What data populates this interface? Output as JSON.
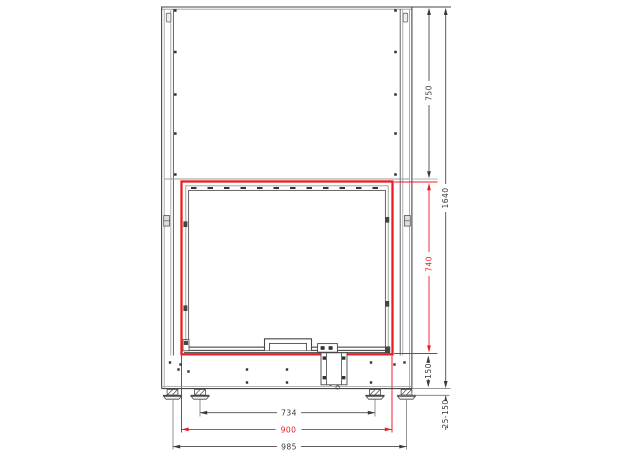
{
  "drawing": {
    "description": "Front elevation technical drawing of a fireplace insert with leveling feet and highlighted firebox opening",
    "colors": {
      "accent_red": "#ed1c24",
      "line_dark": "#474747",
      "line_light": "#9b9b9b"
    },
    "dimensions": {
      "top_section_height": "750",
      "overall_height": "1640",
      "opening_height": "740",
      "plinth_height": "150",
      "leveling_feet_range": "25-150",
      "feet_spacing": "734",
      "opening_width": "900",
      "feet_outer_spacing": "985"
    }
  }
}
